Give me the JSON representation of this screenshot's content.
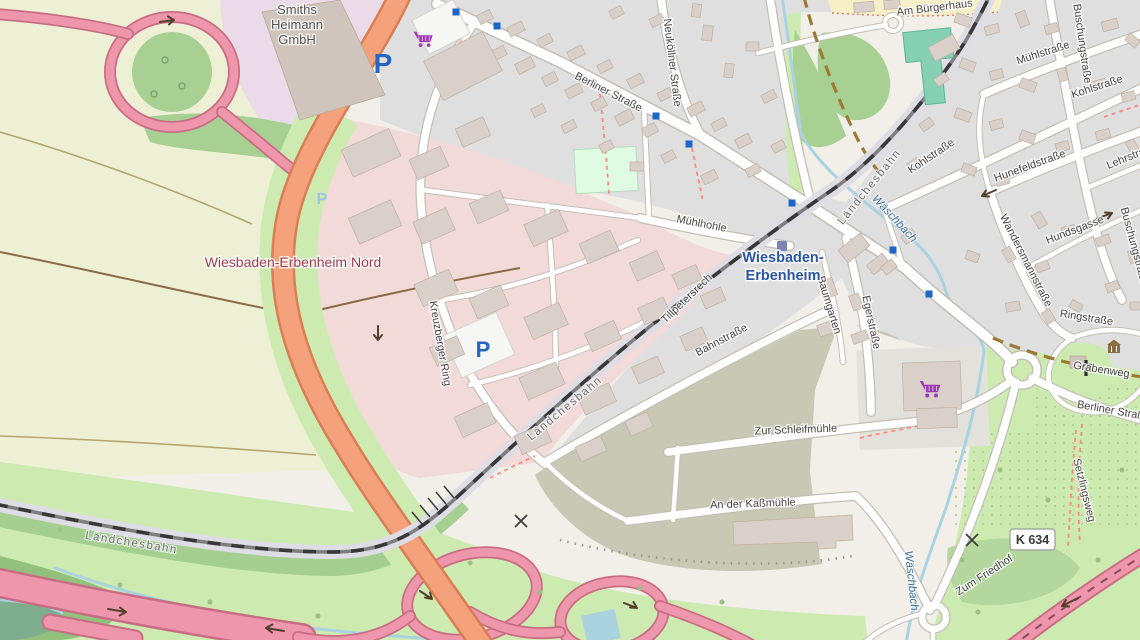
{
  "map": {
    "labels": {
      "places": [
        {
          "t": "Wiesbaden-Erbenheim Nord",
          "x": 293,
          "y": 267,
          "r": 0
        },
        {
          "t": "Wiesbaden-",
          "x": 783,
          "y": 262,
          "r": 0,
          "station": true
        },
        {
          "t": "Erbenheim",
          "x": 783,
          "y": 280,
          "r": 0,
          "station": true
        }
      ],
      "pois": [
        {
          "t": "Smiths",
          "x": 297,
          "y": 14,
          "r": 0
        },
        {
          "t": "Heimann",
          "x": 297,
          "y": 29,
          "r": 0
        },
        {
          "t": "GmbH",
          "x": 297,
          "y": 44,
          "r": 0
        }
      ],
      "streets": [
        {
          "t": "Berliner Straße",
          "x": 607,
          "y": 95,
          "r": 27
        },
        {
          "t": "Neuköllner Straße",
          "x": 669,
          "y": 63,
          "r": 83
        },
        {
          "t": "Mühlhohle",
          "x": 701,
          "y": 227,
          "r": 11
        },
        {
          "t": "Tillpetersrech",
          "x": 689,
          "y": 301,
          "r": -44
        },
        {
          "t": "Kreuzberger Ring",
          "x": 437,
          "y": 344,
          "r": 80
        },
        {
          "t": "Bahnstraße",
          "x": 723,
          "y": 343,
          "r": -28
        },
        {
          "t": "Baumgarten",
          "x": 826,
          "y": 306,
          "r": 73
        },
        {
          "t": "Egerstraße",
          "x": 868,
          "y": 323,
          "r": 78
        },
        {
          "t": "Zur Schleifmühle",
          "x": 796,
          "y": 433,
          "r": -2
        },
        {
          "t": "An der Kaßmühle",
          "x": 753,
          "y": 507,
          "r": -2
        },
        {
          "t": "Zum Friedhof",
          "x": 986,
          "y": 578,
          "r": -33
        },
        {
          "t": "Grabenweg",
          "x": 1101,
          "y": 373,
          "r": 9
        },
        {
          "t": "Setzlingsweg",
          "x": 1081,
          "y": 491,
          "r": 76
        },
        {
          "t": "Berliner Straße",
          "x": 1113,
          "y": 414,
          "r": 10
        },
        {
          "t": "Mühlstraße",
          "x": 1044,
          "y": 56,
          "r": -18
        },
        {
          "t": "Buschungstraße",
          "x": 1079,
          "y": 44,
          "r": 82
        },
        {
          "t": "Buschungstraße",
          "x": 1131,
          "y": 247,
          "r": 75
        },
        {
          "t": "Kohlstraße",
          "x": 933,
          "y": 159,
          "r": -34
        },
        {
          "t": "Kohlstraße",
          "x": 1098,
          "y": 90,
          "r": -18
        },
        {
          "t": "Hunefeldstraße",
          "x": 1031,
          "y": 169,
          "r": -20
        },
        {
          "t": "Lehrstraße",
          "x": 1133,
          "y": 159,
          "r": -22
        },
        {
          "t": "Wandersmannstraße",
          "x": 1023,
          "y": 262,
          "r": 63
        },
        {
          "t": "Hundsgasse",
          "x": 1076,
          "y": 233,
          "r": -21
        },
        {
          "t": "Ringstraße",
          "x": 1086,
          "y": 321,
          "r": 9
        },
        {
          "t": "Am Bürgerhaus",
          "x": 935,
          "y": 11,
          "r": -7
        }
      ],
      "railways": [
        {
          "t": "Ländchesbahn",
          "x": 131,
          "y": 546,
          "r": 9
        },
        {
          "t": "Ländchesbahn",
          "x": 567,
          "y": 411,
          "r": -40
        },
        {
          "t": "Ländchesbahn",
          "x": 872,
          "y": 189,
          "r": -51
        }
      ],
      "waters": [
        {
          "t": "Wäschbach",
          "x": 892,
          "y": 221,
          "r": 47
        },
        {
          "t": "Wäschbach",
          "x": 908,
          "y": 581,
          "r": 84
        }
      ]
    },
    "shield": {
      "text": "K 634"
    },
    "icons": [
      {
        "type": "parking-icon",
        "x": 383,
        "y": 63,
        "size": 28
      },
      {
        "type": "parking-icon",
        "x": 483,
        "y": 349,
        "size": 22
      },
      {
        "type": "parking-faint-icon",
        "x": 322,
        "y": 198,
        "size": 16
      },
      {
        "type": "supermarket-icon",
        "x": 424,
        "y": 41,
        "size": 1.15
      },
      {
        "type": "supermarket-icon",
        "x": 931,
        "y": 391,
        "size": 1.25
      },
      {
        "type": "bus-stop-icon",
        "x": 456,
        "y": 12,
        "size": 1
      },
      {
        "type": "bus-stop-icon",
        "x": 497,
        "y": 26,
        "size": 1
      },
      {
        "type": "bus-stop-icon",
        "x": 656,
        "y": 116,
        "size": 1
      },
      {
        "type": "bus-stop-icon",
        "x": 689,
        "y": 144,
        "size": 1
      },
      {
        "type": "bus-stop-icon",
        "x": 792,
        "y": 203,
        "size": 1
      },
      {
        "type": "bus-stop-icon",
        "x": 893,
        "y": 250,
        "size": 1
      },
      {
        "type": "bus-stop-icon",
        "x": 929,
        "y": 294,
        "size": 1
      },
      {
        "type": "railway-station-icon",
        "x": 782,
        "y": 246,
        "size": 1
      },
      {
        "type": "church-icon",
        "x": 1086,
        "y": 368,
        "size": 1
      },
      {
        "type": "museum-icon",
        "x": 1114,
        "y": 347,
        "size": 1
      },
      {
        "type": "gate-icon",
        "x": 521,
        "y": 521,
        "size": 1
      },
      {
        "type": "gate-icon",
        "x": 972,
        "y": 540,
        "size": 1
      }
    ],
    "colors": {
      "farmland": "#eef0d5",
      "residential": "#e0dfdf",
      "commercial": "#f2dad9",
      "industrial": "#ebdbe8",
      "brownfield": "#c8c8b4",
      "grass": "#cdebb0",
      "wood": "#a8d093",
      "water": "#aad3df",
      "trunk_road": "#f4a17c",
      "motorway": "#ee96ab",
      "building": "#d9d0c9",
      "place_red": "#a23b52",
      "station_blue": "#2b55a5",
      "parking_blue": "#2466c2",
      "supermarket_purple": "#9c3ab8",
      "bus_stop_blue": "#1d66c9"
    }
  }
}
